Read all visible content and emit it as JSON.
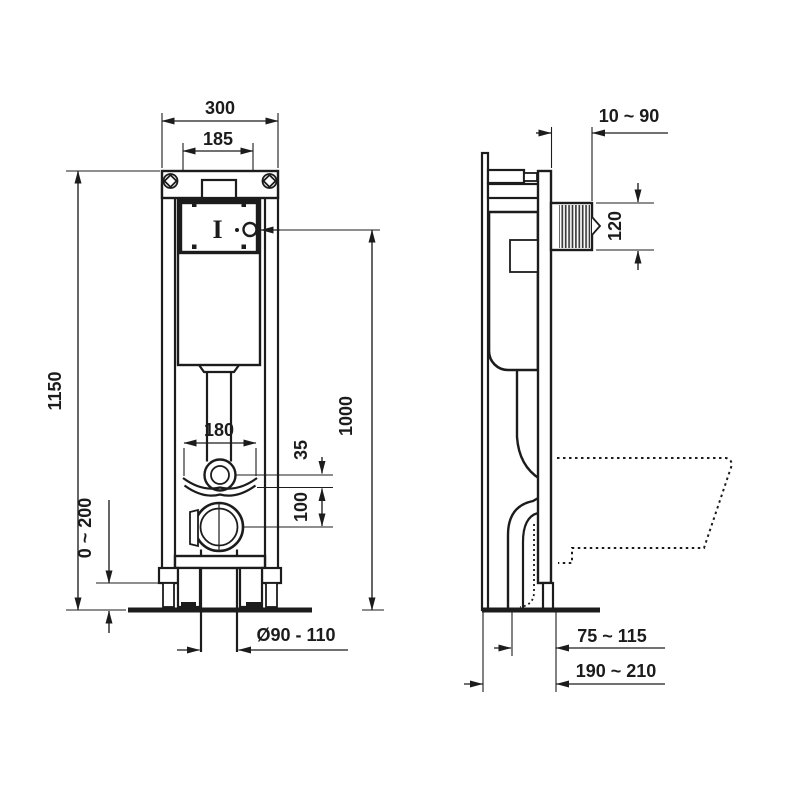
{
  "colors": {
    "line": "#1c1c1c",
    "background": "#ffffff"
  },
  "front_view": {
    "dims": {
      "overall_width": "300",
      "plate_width": "185",
      "overall_height": "1150",
      "flush_height": "1000",
      "bracket_width": "180",
      "bend_offset": "35",
      "drain_offset": "100",
      "foot_adjust": "0 ~ 200",
      "drain_diameter": "Ø90 - 110"
    },
    "plate_mark": "I"
  },
  "side_view": {
    "dims": {
      "wall_clearance": "10 ~ 90",
      "shaft_height": "120",
      "drain_wall_distance": "75 ~ 115",
      "frame_depth": "190 ~ 210"
    }
  }
}
